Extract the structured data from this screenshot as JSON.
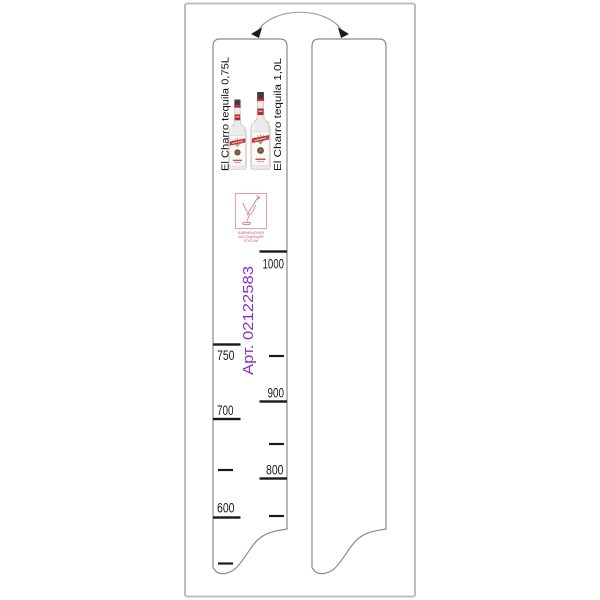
{
  "image_type": "product drawing of two-sided bar bottle level strip (flip ruler)",
  "colors": {
    "background": "#ffffff",
    "outer_frame": "#b8b8b8",
    "strip_outline": "#8a8a8a",
    "tick_and_number": "#1a1a1a",
    "article_text": "#8b2fc9",
    "bottle_red": "#c0272d",
    "logo_pink": "#c97583"
  },
  "flip_arrow": {
    "meaning": "strip is printed on both sides (flip over)"
  },
  "front_strip": {
    "variant_075_label": "El Charro tequila  0,75L",
    "variant_10_label": "El Charro tequila  1,0L",
    "article": "Арт. 02122583",
    "logo": {
      "caption_lines": [
        "БАРМЕНСКАЯ",
        "АССОЦИАЦИЯ",
        "РОССИИ"
      ]
    },
    "scale_075": {
      "side": "left",
      "label_750": "750",
      "label_700": "700",
      "label_600": "600",
      "ticks": [
        {
          "value": 750,
          "size": "major",
          "label_position": "below-tick"
        },
        {
          "value": 700,
          "size": "major",
          "label_position": "above-tick"
        },
        {
          "value": 650,
          "size": "minor"
        },
        {
          "value": 600,
          "size": "major",
          "label_position": "above-tick"
        },
        {
          "value": 550,
          "size": "minor"
        }
      ]
    },
    "scale_10": {
      "side": "right",
      "label_1000": "1000",
      "label_900": "900",
      "label_800": "800",
      "ticks": [
        {
          "value": 1000,
          "size": "major",
          "label_position": "below-tick"
        },
        {
          "value": 950,
          "size": "minor"
        },
        {
          "value": 900,
          "size": "major",
          "label_position": "above-tick"
        },
        {
          "value": 850,
          "size": "minor"
        },
        {
          "value": 800,
          "size": "major",
          "label_position": "above-tick"
        },
        {
          "value": 750,
          "size": "minor"
        }
      ]
    }
  },
  "back_strip": {
    "content": "blank"
  }
}
